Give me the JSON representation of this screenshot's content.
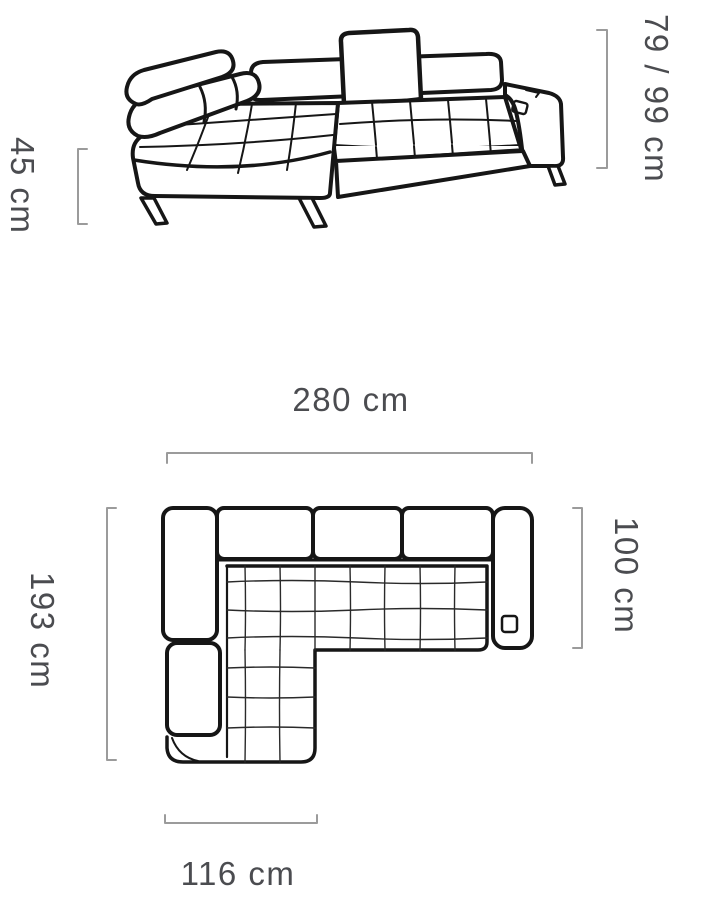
{
  "colors": {
    "outline": "#161616",
    "quilt_line": "#2a2a2a",
    "dimension_line": "#9b9b9b",
    "label_text": "#4b4c50"
  },
  "front_view": {
    "seat_height_label": "45 cm",
    "back_height_label": "79 / 99 cm"
  },
  "plan_view": {
    "total_width_label": "280 cm",
    "total_depth_label": "193 cm",
    "seat_depth_label": "100 cm",
    "chaise_width_label": "116 cm"
  }
}
